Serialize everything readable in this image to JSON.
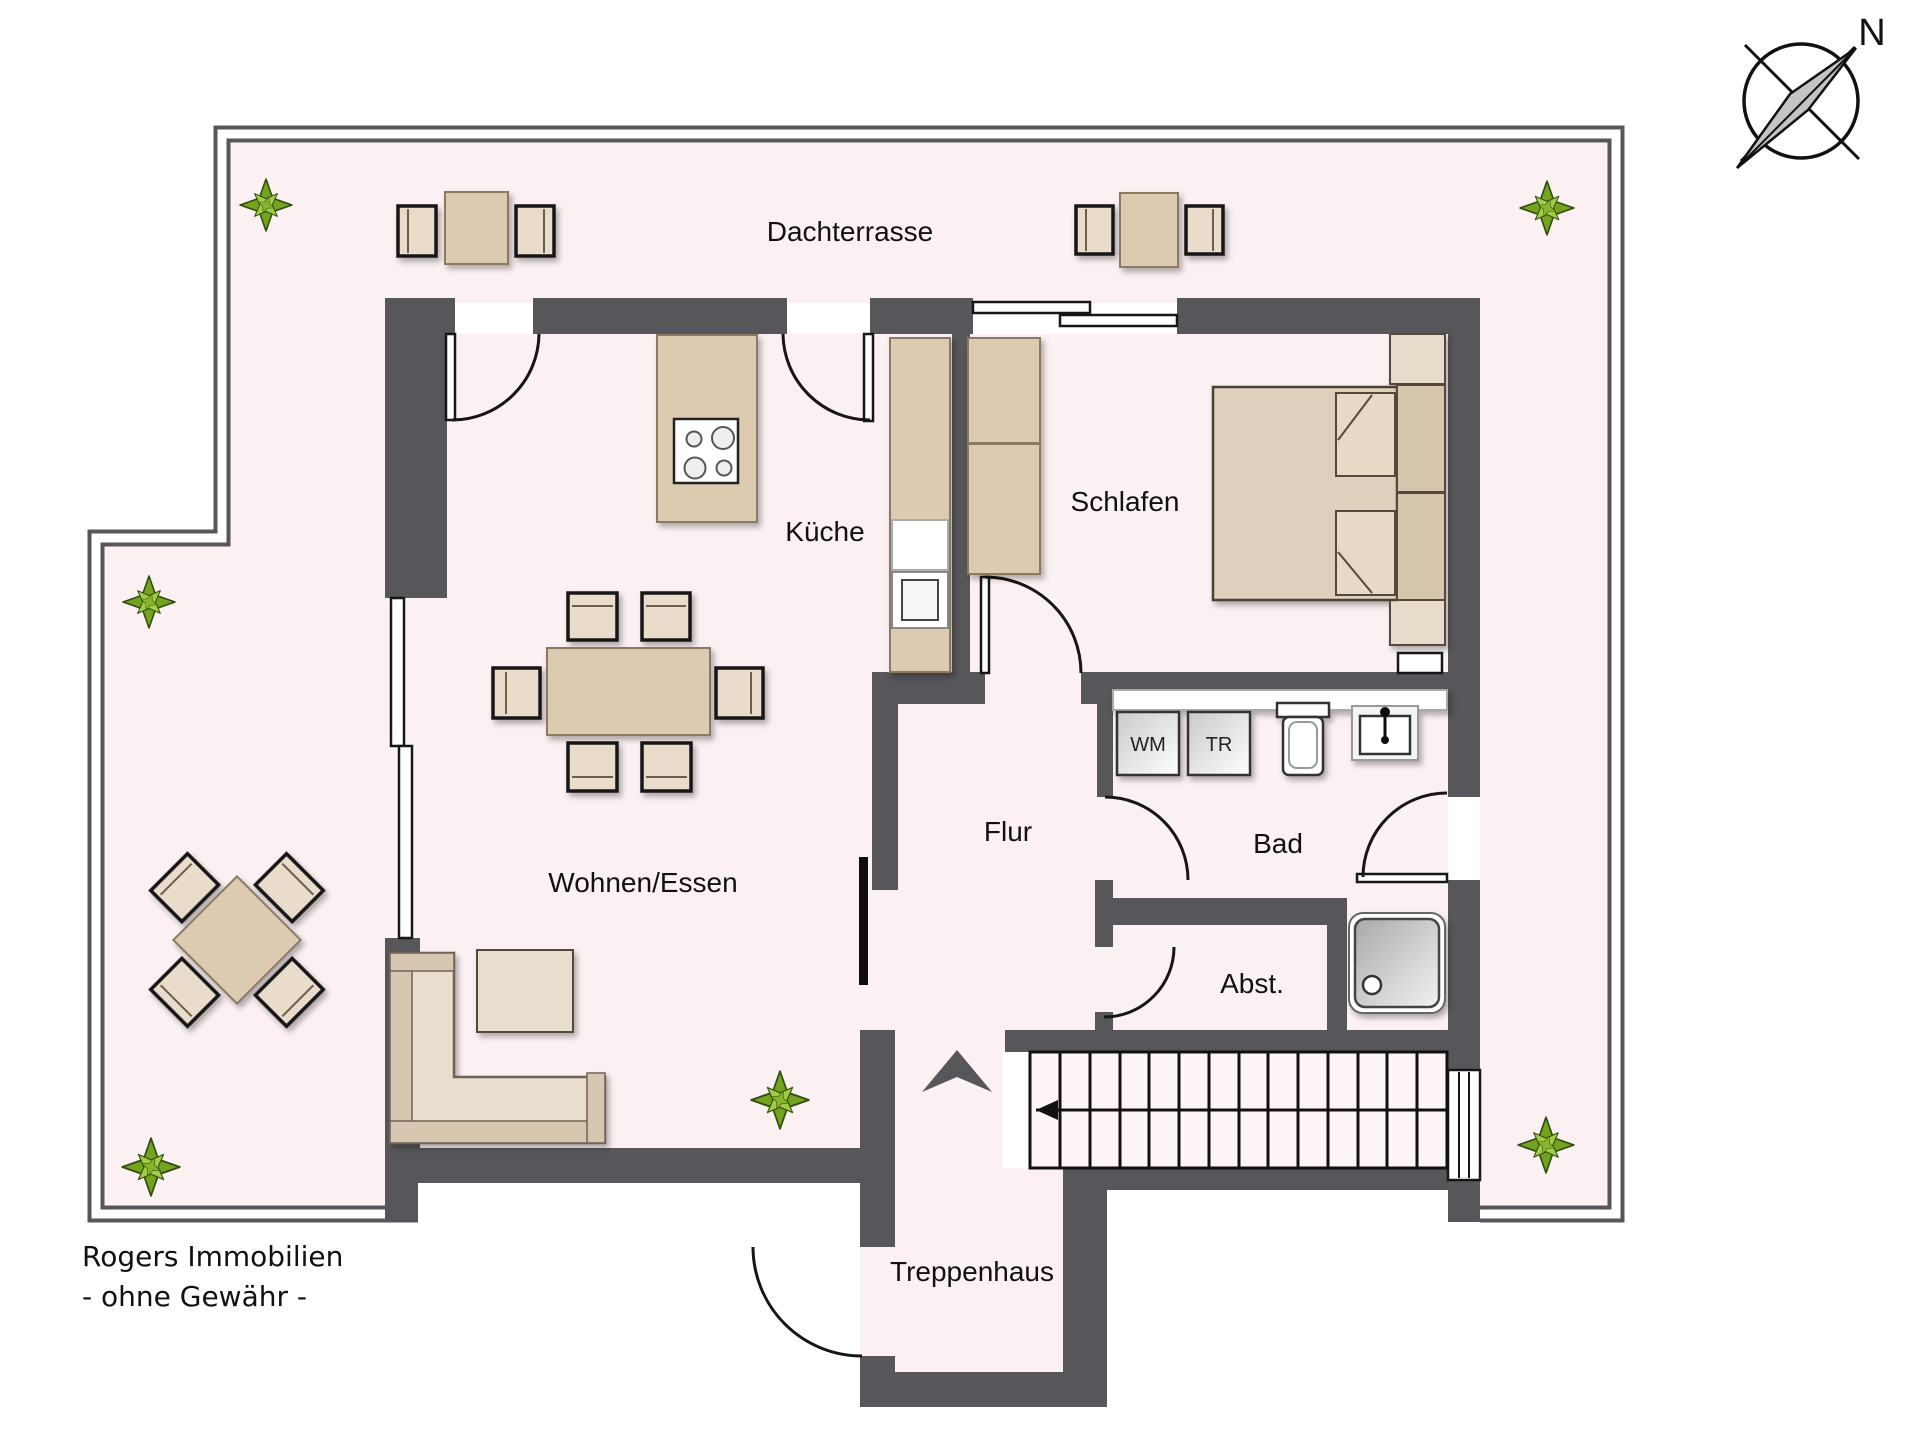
{
  "page": {
    "type": "floor-plan",
    "background": "#ffffff"
  },
  "colors": {
    "floor": "#fbf0f2",
    "wall": "#57565a",
    "line": "#161616",
    "furn": "#dccbb1",
    "furn-light": "#e9dccb",
    "furn-dark": "#d8c7b0",
    "metal": "#c4c4c4"
  },
  "compass": {
    "north_label": "N"
  },
  "rooms": {
    "dachterrasse": {
      "label": "Dachterrasse"
    },
    "kueche": {
      "label": "Küche"
    },
    "schlafen": {
      "label": "Schlafen"
    },
    "wohnen_essen": {
      "label": "Wohnen/Essen"
    },
    "flur": {
      "label": "Flur"
    },
    "bad": {
      "label": "Bad"
    },
    "abstellraum": {
      "label": "Abst."
    },
    "treppenhaus": {
      "label": "Treppenhaus"
    }
  },
  "appliances": {
    "washing_machine_label": "WM",
    "dryer_label": "TR"
  },
  "footer": {
    "line1": "Rogers Immobilien",
    "line2": "- ohne Gewähr -"
  }
}
